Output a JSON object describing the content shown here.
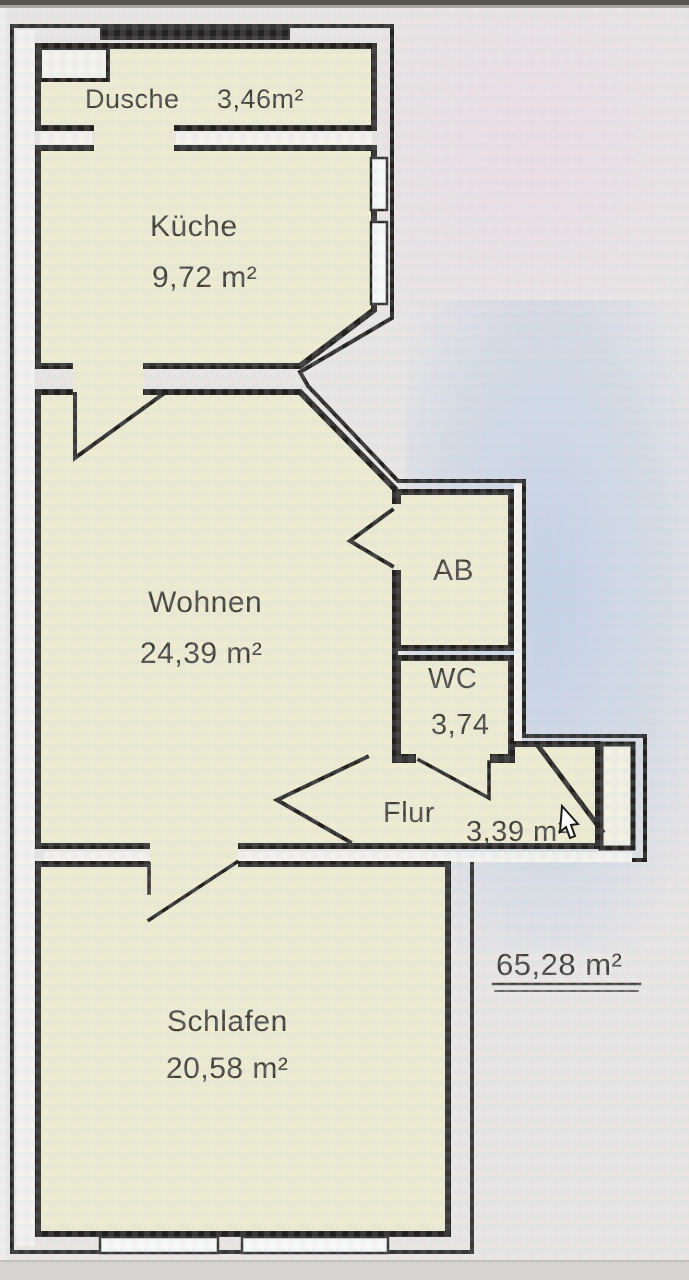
{
  "floor_plan": {
    "rooms": [
      {
        "label": "Dusche",
        "area": "3,46m²"
      },
      {
        "label": "Küche",
        "area": "9,72 m²"
      },
      {
        "label": "Wohnen",
        "area": "24,39 m²"
      },
      {
        "label": "AB",
        "area": ""
      },
      {
        "label": "WC",
        "area": "3,74"
      },
      {
        "label": "Flur",
        "area": "3,39 m²"
      },
      {
        "label": "Schlafen",
        "area": "20,58 m²"
      }
    ],
    "total_area": "65,28 m²",
    "colors": {
      "wall": "#23221e",
      "room_fill": "#eeeccf",
      "paper": "#e9e7e3",
      "blue_tint": "#a5c0e8",
      "text": "#403f39"
    },
    "icons": {
      "cursor": "arrow-pointer"
    }
  }
}
